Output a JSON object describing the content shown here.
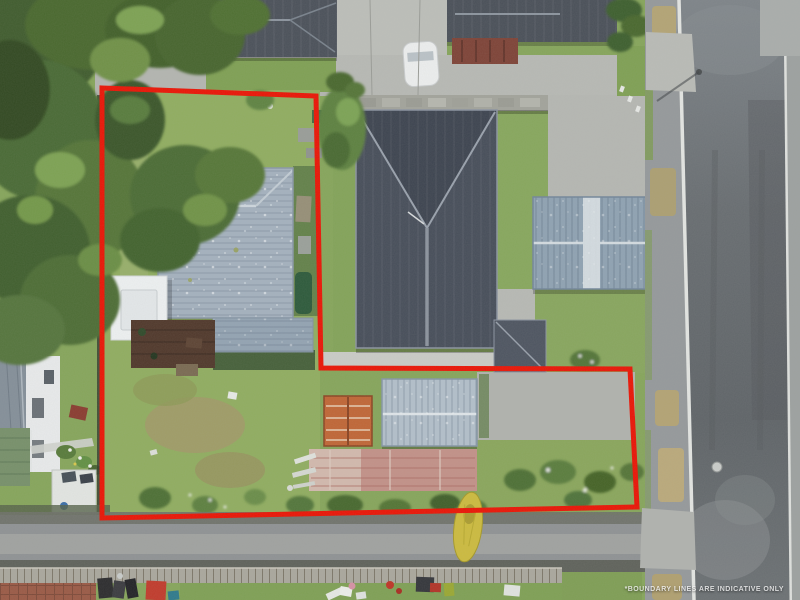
{
  "watermark": {
    "text": "*BOUNDARY LINES ARE INDICATIVE ONLY"
  },
  "boundary": {
    "color": "#ea1506",
    "width_px": 5
  },
  "scene_colors": {
    "grass_green": "#86a55b",
    "tree_dark_green": "#42602f",
    "subject_roof_weathered_grey": "#a4b1be",
    "carport_white": "#edf0f1",
    "deck_brown": "#50382b",
    "neighbour_roof_slate": "#474e5a",
    "garage_steel_blue": "#8fa2b2",
    "shed_rust_orange": "#c06636",
    "shed_silver": "#b2bfca",
    "rear_roof_faded_red": "#c29188",
    "kayak_yellow": "#ccbb3f",
    "road_asphalt": "#64696d",
    "concrete_light": "#b7b9b4"
  }
}
